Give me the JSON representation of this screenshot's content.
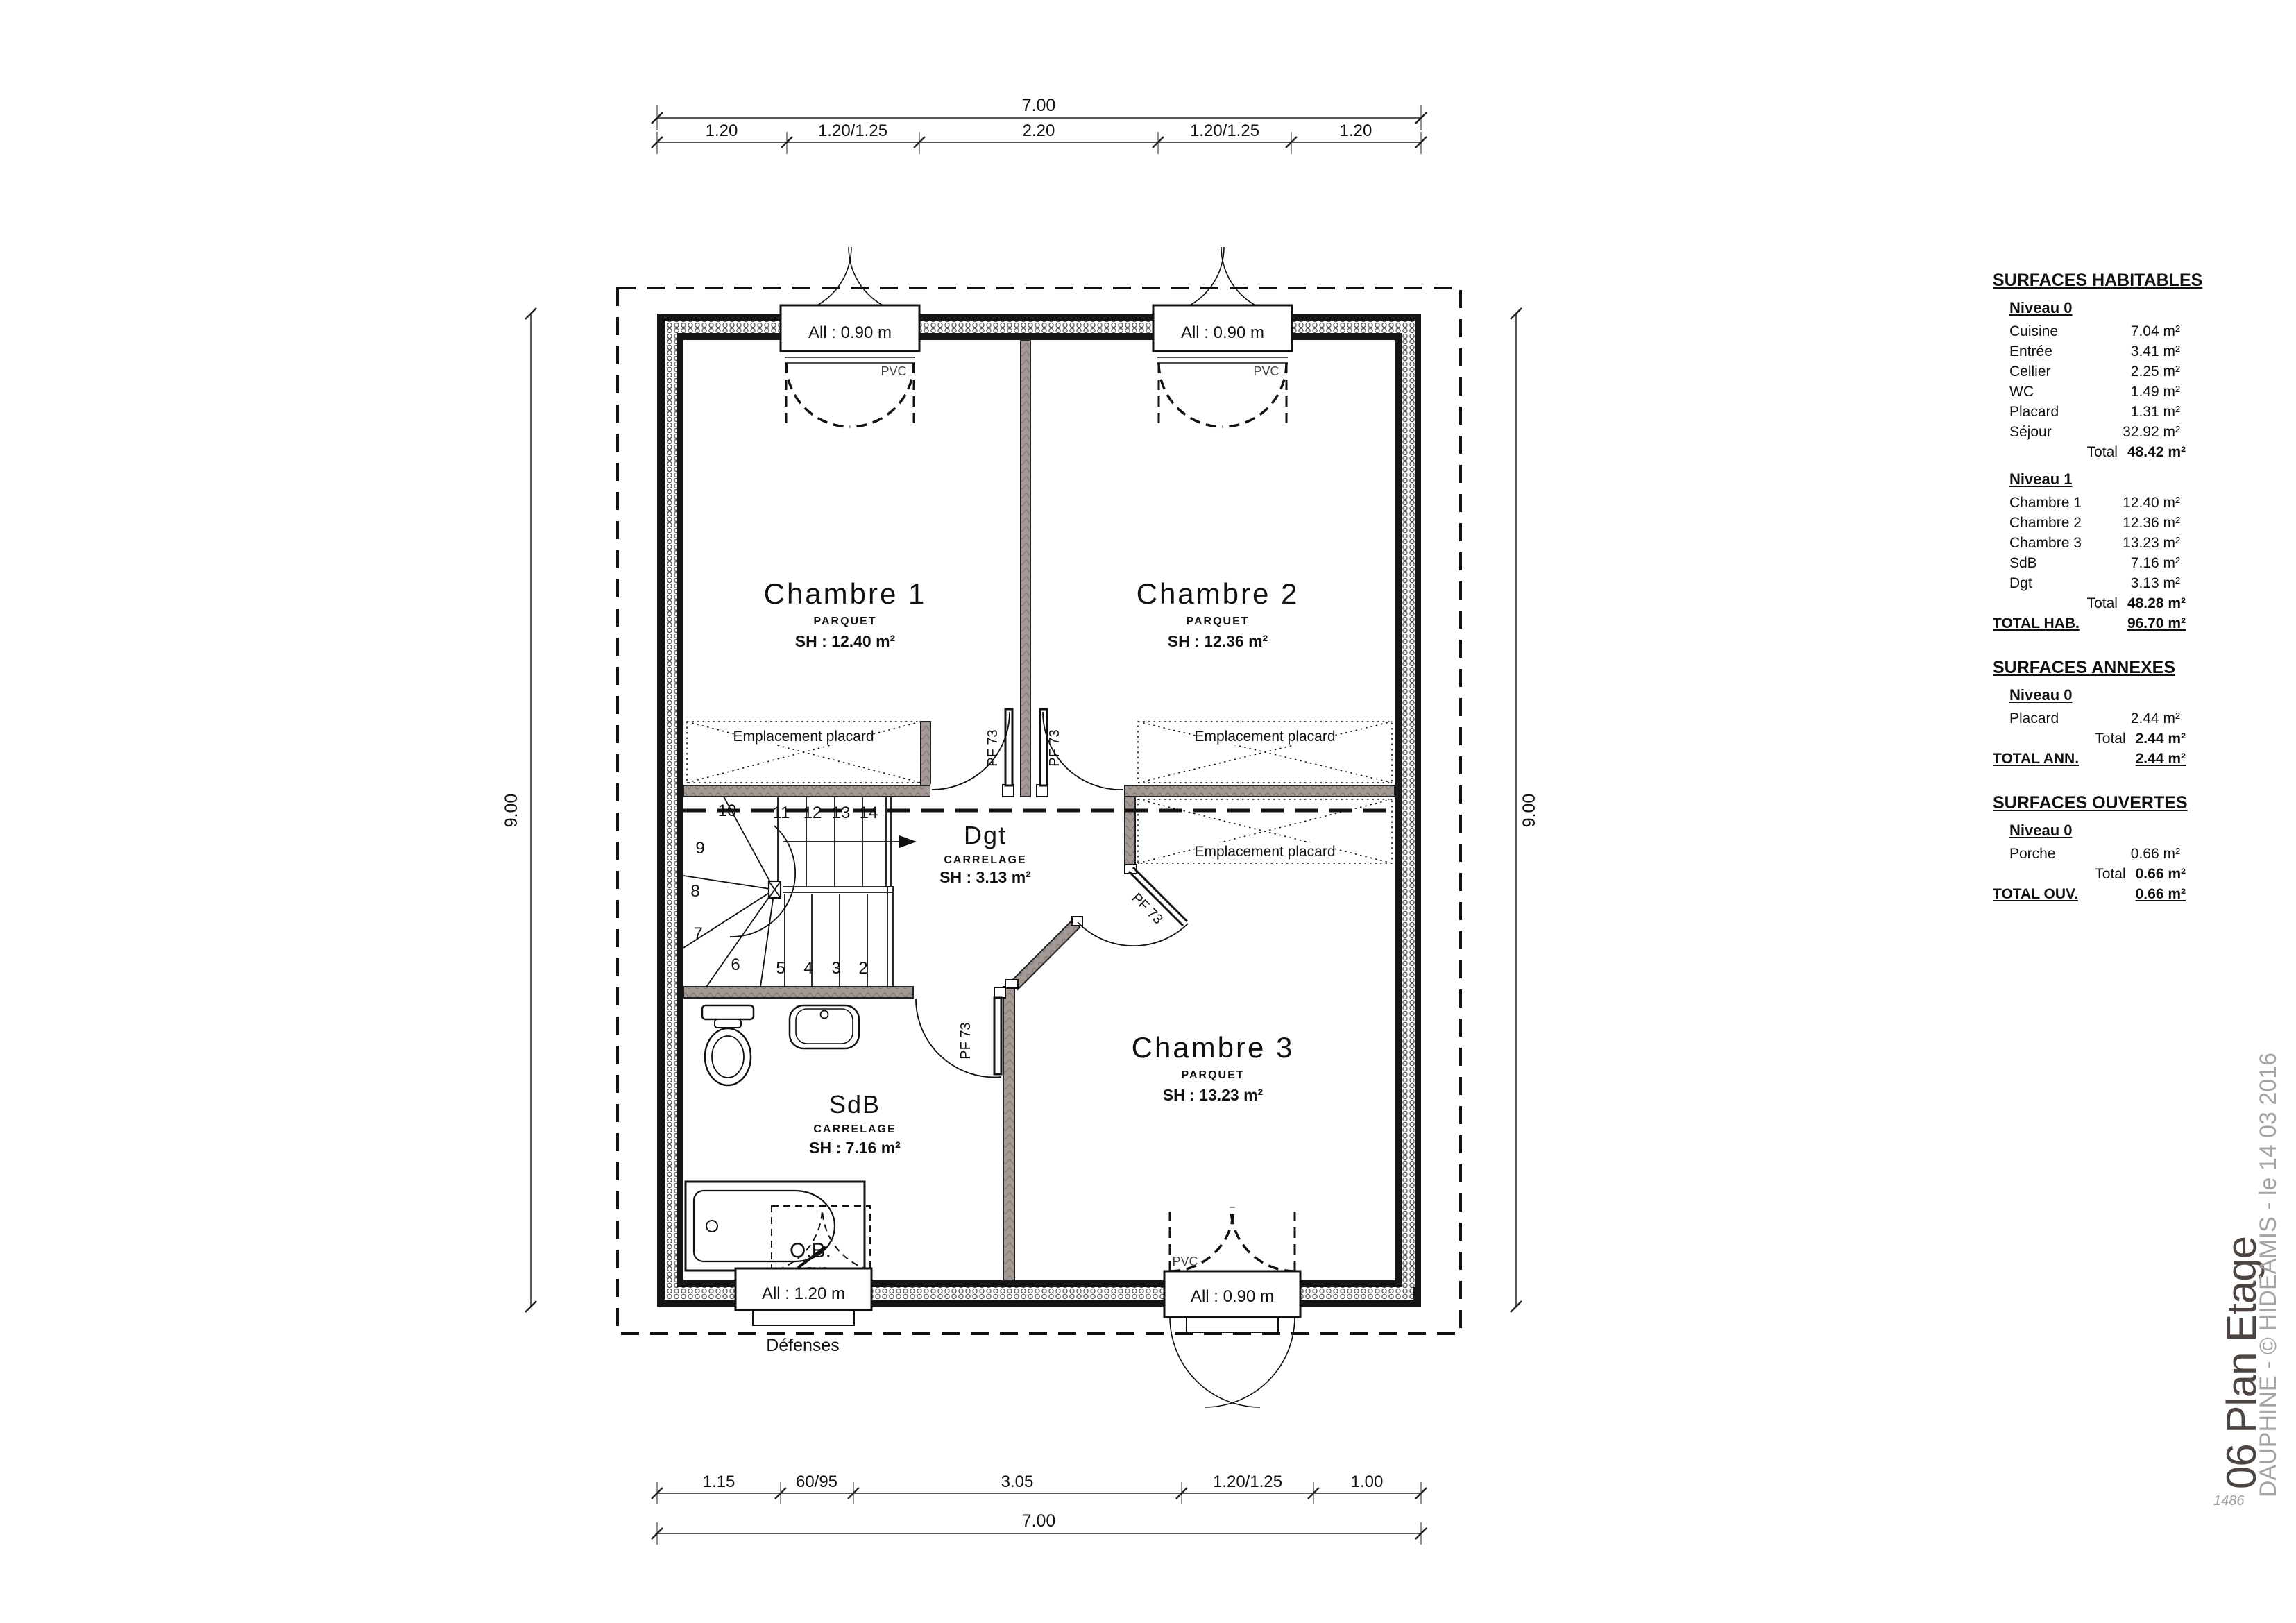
{
  "plan": {
    "rooms": [
      {
        "name": "Chambre 1",
        "floor": "PARQUET",
        "sh": "SH : 12.40 m²"
      },
      {
        "name": "Chambre 2",
        "floor": "PARQUET",
        "sh": "SH : 12.36 m²"
      },
      {
        "name": "Chambre 3",
        "floor": "PARQUET",
        "sh": "SH : 13.23 m²"
      },
      {
        "name": "SdB",
        "floor": "CARRELAGE",
        "sh": "SH : 7.16 m²"
      },
      {
        "name": "Dgt",
        "floor": "CARRELAGE",
        "sh": "SH : 3.13 m²"
      }
    ],
    "labels": {
      "placard": "Emplacement placard",
      "door": "PF 73",
      "defenses": "Défenses",
      "ob": "O.B.",
      "pvc": "PVC"
    },
    "windows": {
      "w090": "All : 0.90 m",
      "w120": "All : 1.20 m"
    },
    "stairs": {
      "numbers": [
        "2",
        "3",
        "4",
        "5",
        "6",
        "7",
        "8",
        "9",
        "10",
        "11",
        "12",
        "13",
        "14"
      ]
    },
    "dims": {
      "top_total": "7.00",
      "top_segments": [
        "1.20",
        "1.20/1.25",
        "2.20",
        "1.20/1.25",
        "1.20"
      ],
      "bottom_segments": [
        "1.15",
        "60/95",
        "3.05",
        "1.20/1.25",
        "1.00"
      ],
      "bottom_total": "7.00",
      "left": "9.00",
      "right": "9.00"
    }
  },
  "surfaces": {
    "habitables": {
      "title": "SURFACES HABITABLES",
      "niveau0": {
        "title": "Niveau 0",
        "rows": [
          [
            "Cuisine",
            "7.04 m²"
          ],
          [
            "Entrée",
            "3.41 m²"
          ],
          [
            "Cellier",
            "2.25 m²"
          ],
          [
            "WC",
            "1.49 m²"
          ],
          [
            "Placard",
            "1.31 m²"
          ],
          [
            "Séjour",
            "32.92 m²"
          ]
        ],
        "total_label": "Total",
        "total": "48.42 m²"
      },
      "niveau1": {
        "title": "Niveau 1",
        "rows": [
          [
            "Chambre 1",
            "12.40 m²"
          ],
          [
            "Chambre 2",
            "12.36 m²"
          ],
          [
            "Chambre 3",
            "13.23 m²"
          ],
          [
            "SdB",
            "7.16 m²"
          ],
          [
            "Dgt",
            "3.13 m²"
          ]
        ],
        "total_label": "Total",
        "total": "48.28 m²"
      },
      "grand_label": "TOTAL HAB.",
      "grand": "96.70 m²"
    },
    "annexes": {
      "title": "SURFACES ANNEXES",
      "niveau0": {
        "title": "Niveau 0",
        "rows": [
          [
            "Placard",
            "2.44 m²"
          ]
        ],
        "total_label": "Total",
        "total": "2.44 m²"
      },
      "grand_label": "TOTAL ANN.",
      "grand": "2.44 m²"
    },
    "ouvertes": {
      "title": "SURFACES OUVERTES",
      "niveau0": {
        "title": "Niveau 0",
        "rows": [
          [
            "Porche",
            "0.66 m²"
          ]
        ],
        "total_label": "Total",
        "total": "0.66 m²"
      },
      "grand_label": "TOTAL OUV.",
      "grand": "0.66 m²"
    }
  },
  "titleblock": {
    "title": "06 Plan Etage",
    "subtitle": "DAUPHINE - © HIDEAMIS - le 14 03 2016",
    "ref": "1486"
  }
}
